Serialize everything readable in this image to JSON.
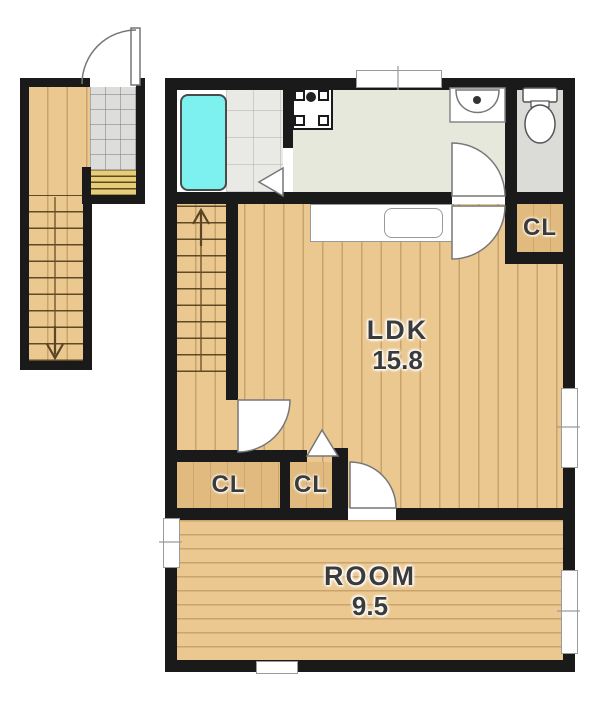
{
  "plan": {
    "type": "apartment-floor-plan",
    "rooms": {
      "ldk": {
        "name": "LDK",
        "area": "15.8"
      },
      "bedroom": {
        "name": "ROOM",
        "area": "9.5"
      },
      "closet_upper_right": {
        "label": "CL"
      },
      "closet_lower_left": {
        "label": "CL"
      },
      "closet_lower_middle": {
        "label": "CL"
      }
    },
    "fixtures": {
      "bathtub": "bathtub",
      "wash_basin": "wash-basin",
      "washing_machine_pan": "washing-machine-pan",
      "toilet": "toilet",
      "kitchen_counter": "kitchen-counter-with-sink",
      "entry_door": "hinged-entry-door",
      "interior_doors": "hinged-door-arcs",
      "folding_doors": "folding-door-triangles",
      "internal_stairs": "stairs-going-up",
      "external_stairs": "stairs-going-down"
    },
    "colors": {
      "wall": "#1a1a1a",
      "wood": "#ebc890",
      "closet": "#e0ba7e",
      "bathtub": "#7df0f0",
      "bath_tile": "#e9e9e5",
      "washroom_floor": "#e5e8da",
      "toilet_floor": "#dbdbd8",
      "entry_tile": "#dddddb",
      "steps": "#e6cd7a"
    }
  }
}
